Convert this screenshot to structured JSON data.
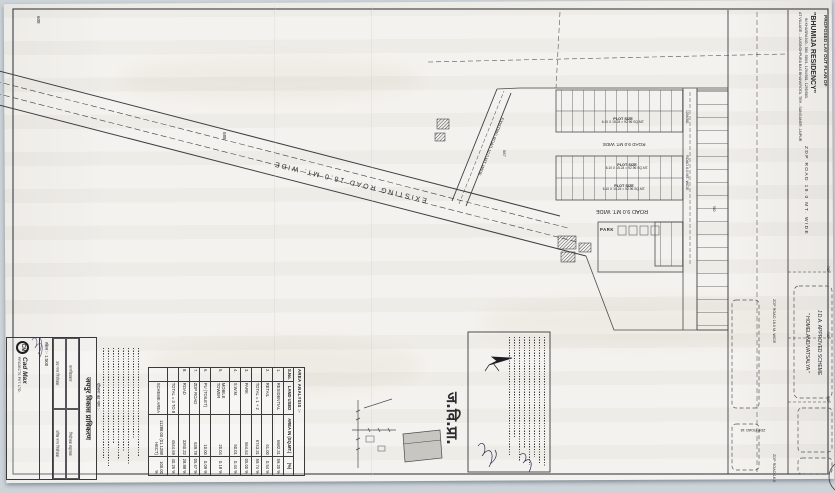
{
  "doc": {
    "type_note": "scanned site layout plan, sheet rotated 90 degrees clockwise"
  },
  "title_block": {
    "line1": "PROPOSED LAY OUT PLAN OF",
    "line2": "\"BHUMIJA RESIDENCY\"",
    "line3": "IN KHASRA NO.- 580, 580/1, 1294/581, 1295/583,",
    "line4": "AT VILLAGE :- JAISINGHPURA BAS BHANKROTA, TEH.- SANGANER, JAIPUR"
  },
  "road_labels": {
    "zdp_top": "ZDP ROAD 18.0 MT. WIDE",
    "existing_18": "EXISTING ROAD 18.0 MT. WIDE",
    "existing_10": "EXISTING ROAD 10.0 MT. WIDE",
    "road9_a": "ROAD 9.0 MT. WIDE",
    "road9_b": "ROAD 9.0 MT. WIDE",
    "road6": "ROAD 6.0 MT. WIDE",
    "zdp_right": "ZDP ROAD 18.0 M. WIDE",
    "zdp_flip": "ZDP ROAD 18",
    "zdp_bottom": "ZDP ROAD 18.0",
    "ro_1": "RO",
    "ro_2": "RO",
    "ro_3": "RO"
  },
  "khasra_numbers": {
    "n608": "608",
    "n588": "588",
    "n587": "587",
    "n1294_581": "1294/581",
    "n580": "580"
  },
  "plot_size": {
    "line1": "PLOT SIZE",
    "line2": "6.10 X 15.24 = 92.96 SQ.MT."
  },
  "park_label": "PARK",
  "jda_scheme": {
    "line1": "J.D.A. APPROVED SCHEME",
    "line2": "\" HOMELAND/VATSALYA \""
  },
  "jvp_mark": "ज.वि.प्रा.",
  "area_table": {
    "title": "AREA ANALYSIS :-",
    "headers": [
      "S.No.",
      "LAND USED",
      "AREA IN (SQ.MT.)",
      "(%)"
    ],
    "rows": [
      [
        "1.",
        "RESIDENTIAL",
        "6682.31",
        "59.20 %"
      ],
      [
        "2.",
        "RETAIL",
        "61.00",
        "0.54 %"
      ],
      [
        "",
        "TOTAL = 1 + 2",
        "6743.31",
        "59.74 %"
      ],
      [
        "3.",
        "PARK",
        "564.64",
        "05.00 %"
      ],
      [
        "4.",
        "S.W.M.",
        "50.01",
        "0.44 %"
      ],
      [
        "5.",
        "MOBILE TOWER",
        "20.04",
        "0.18 %"
      ],
      [
        "6.",
        "PU (TOILET)",
        "10.00",
        "0.09 %"
      ],
      [
        "7.",
        "ZDP ROAD",
        "639.78",
        "05.67 %"
      ],
      [
        "8.",
        "ROAD",
        "3260.22",
        "28.88 %"
      ],
      [
        "",
        "TOTAL = 3 TO 8",
        "4544.69",
        "40.26 %"
      ],
      [
        "",
        "SCHEME AREA",
        "11288.00 (01.1288 HECT)",
        "100.00 %"
      ]
    ]
  },
  "stamp_block": {
    "authority": "जयपुर विकास प्राधिकरण",
    "cells": [
      "मानचित्रकार",
      "नियोजक सहायक",
      "उप नगर नियोजक",
      "वरिष्ठ नगर नियोजक"
    ],
    "scheme_name_label": "योजना का नाम :-",
    "scale": "स्केल :- 1:500",
    "logo": "CM",
    "logo_name": "Cad Max",
    "logo_sub": "PROJECTS PVT. LTD."
  }
}
